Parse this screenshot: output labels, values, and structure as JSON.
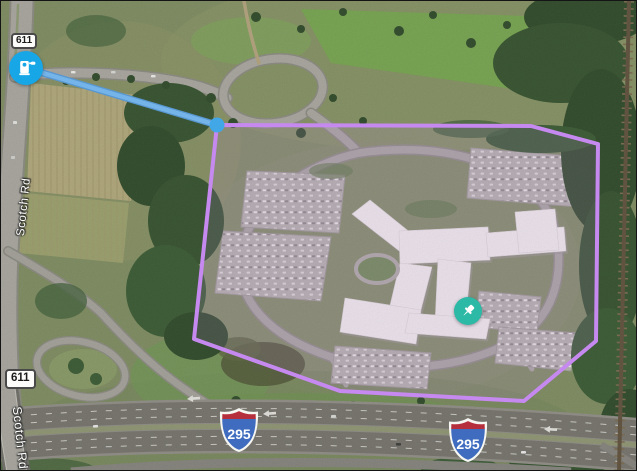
{
  "map": {
    "imagery": "satellite",
    "labels": {
      "route_611": "611",
      "interstate_295": "295",
      "scotch_rd": "Scotch Rd"
    },
    "markers": {
      "ev_charging_station": {
        "icon": "ev-charging-icon",
        "color": "#18a7e6"
      },
      "pinned_place": {
        "icon": "pushpin-icon",
        "color": "#2cb9a6"
      }
    },
    "overlays": {
      "selection_polygon": {
        "color": "#c689f0",
        "points": "216,124 530,125 597,143 595,340 523,400 339,390 193,338"
      },
      "route_line": {
        "color": "#74b4e8",
        "points": "25,67 216,124"
      },
      "route_vertex": {
        "x": "216",
        "y": "124",
        "color": "#41a7e6"
      }
    }
  }
}
